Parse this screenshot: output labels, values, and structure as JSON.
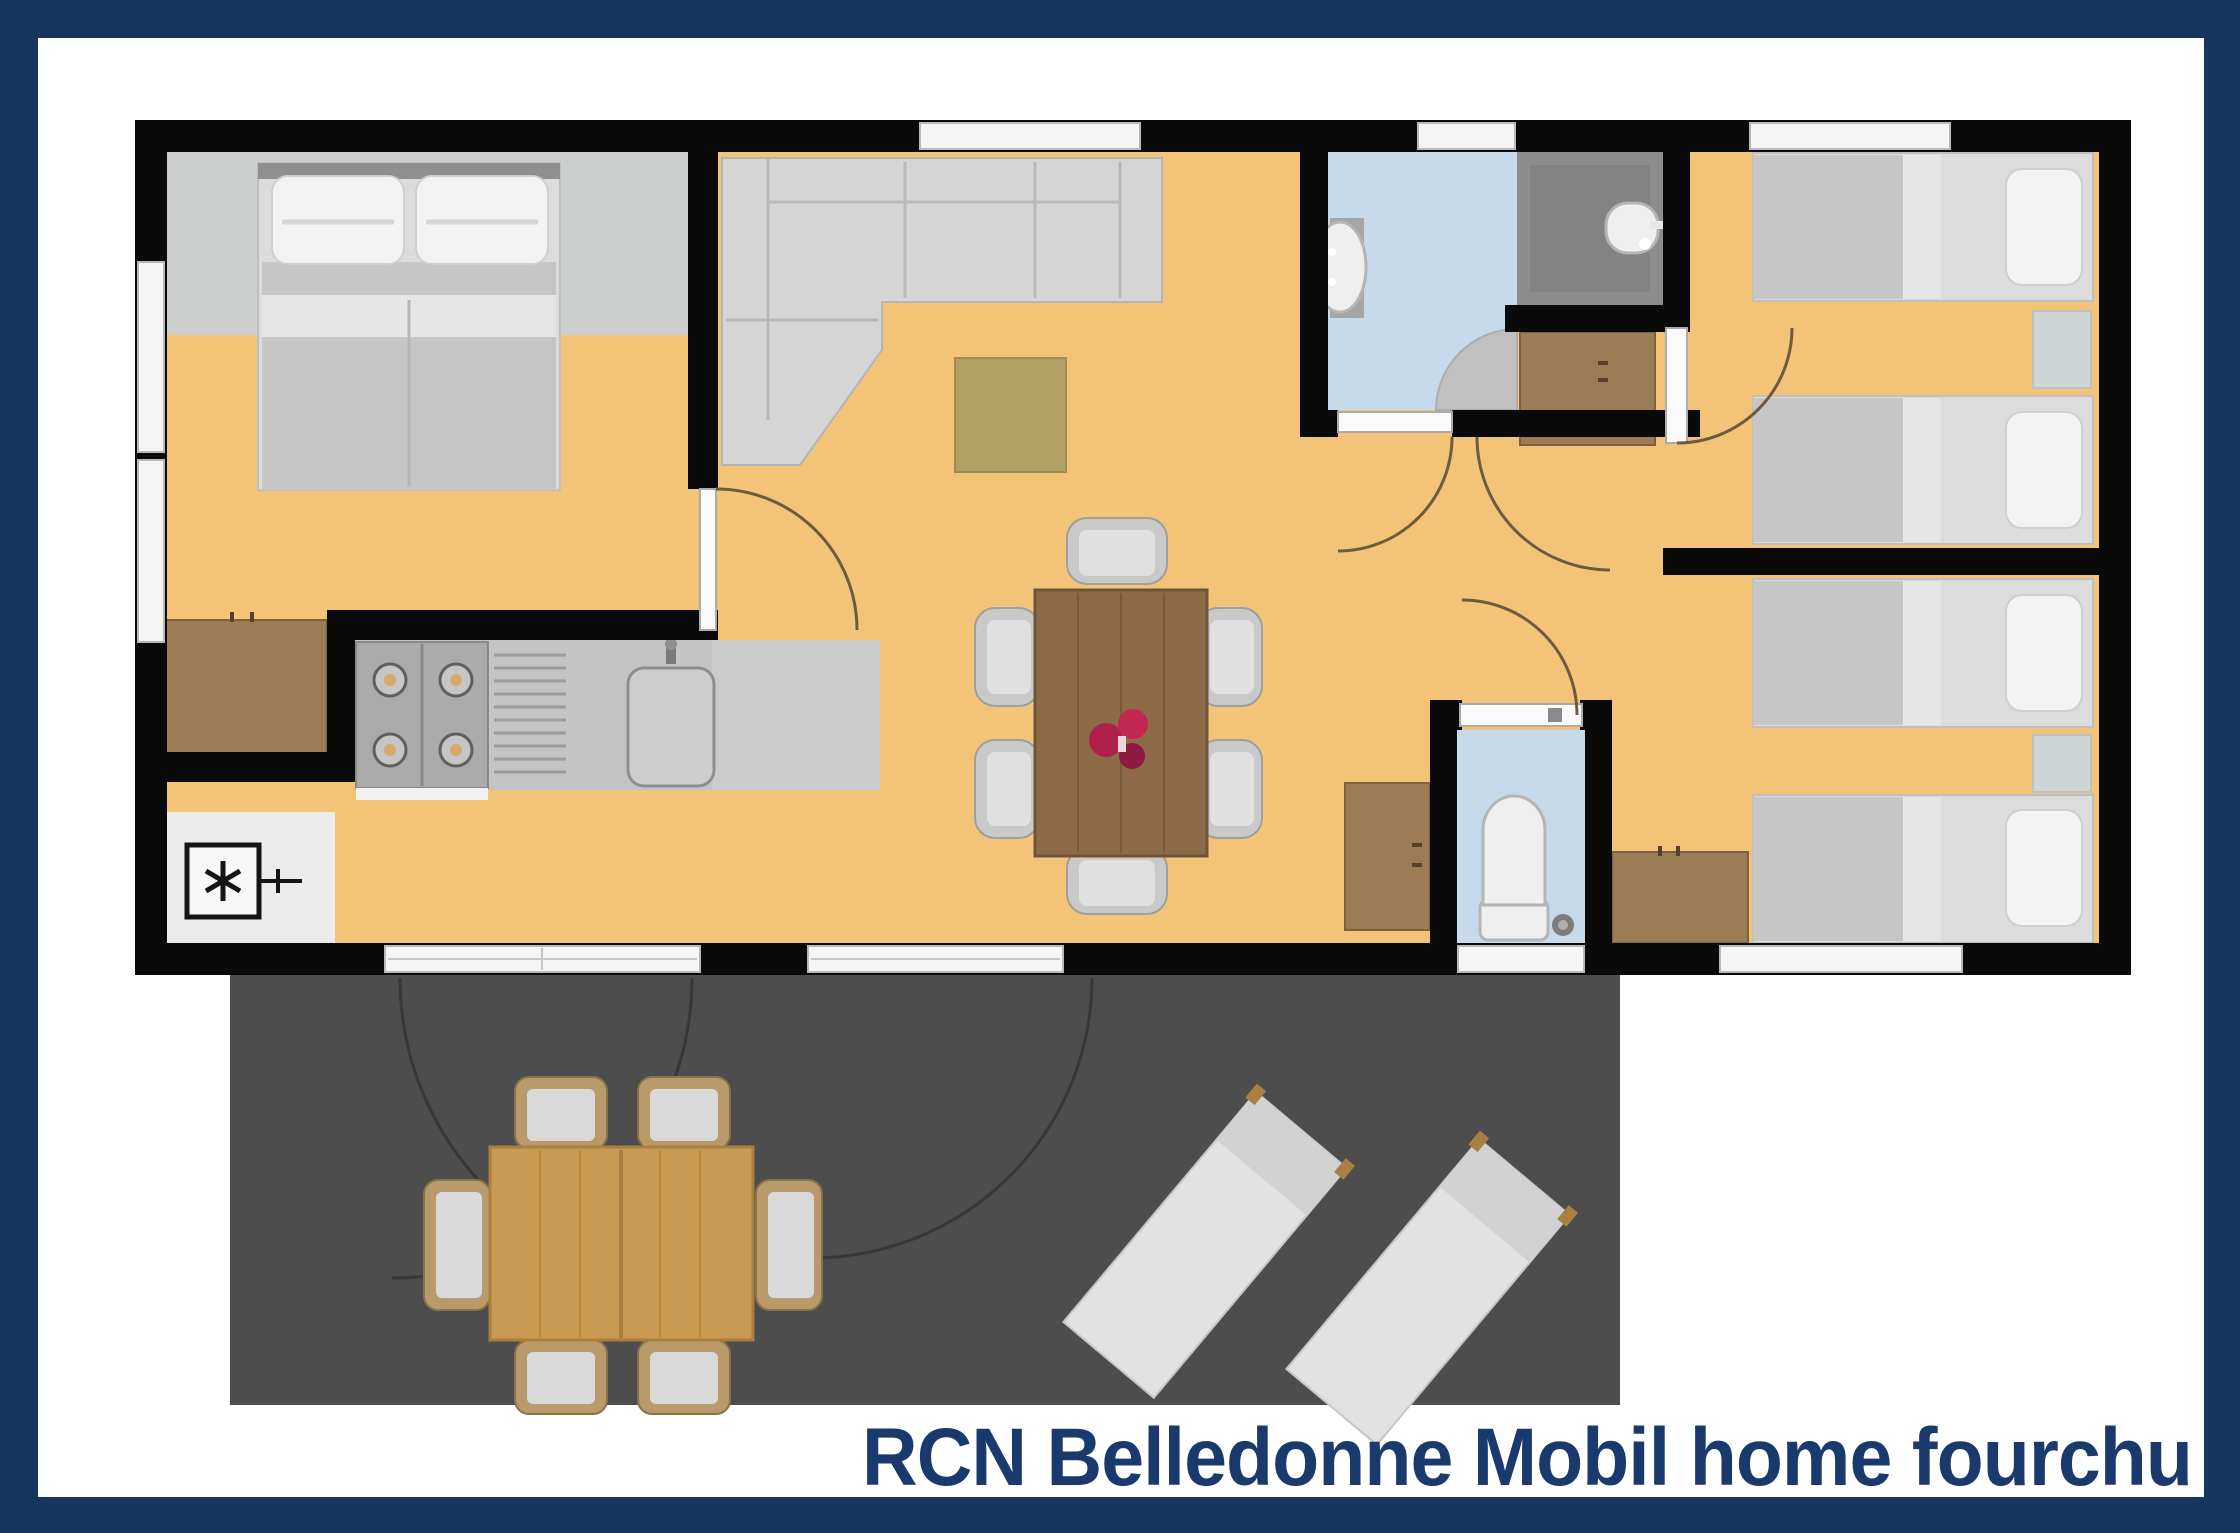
{
  "caption": {
    "text": "RCN Belledonne Mobil home fourchu"
  },
  "colors": {
    "border_navy": "#16365F",
    "caption_navy": "#1A3A6E",
    "wall_black": "#0A0A0A",
    "floor_orange": "#F3C477",
    "bathroom_blue": "#C6DAEC",
    "toilet_blue": "#C6DAEC",
    "shower_gray": "#8D8D8D",
    "bedroom_head_gray": "#CBCECD",
    "terrace_gray": "#4D4D4D",
    "wood_brown": "#9C7C55",
    "dining_table_wood": "#8D6B47",
    "outdoor_table_wood": "#C99B52",
    "rug_olive": "#B2A164",
    "flower_red": "#B0204C"
  },
  "plan": {
    "type": "floor-plan",
    "rooms": [
      {
        "name": "master-bedroom",
        "furniture": [
          "double-bed",
          "wardrobe"
        ]
      },
      {
        "name": "living-room",
        "furniture": [
          "corner-sofa",
          "rug",
          "dining-table",
          "six-chairs",
          "flower-centerpiece"
        ]
      },
      {
        "name": "kitchen",
        "furniture": [
          "fridge-freezer",
          "stove-4-burners",
          "drying-rack",
          "sink",
          "counter"
        ]
      },
      {
        "name": "bathroom",
        "furniture": [
          "washbasin",
          "corner-shower"
        ]
      },
      {
        "name": "shower-room",
        "furniture": [
          "wall-basin"
        ]
      },
      {
        "name": "toilet-room",
        "furniture": [
          "toilet"
        ]
      },
      {
        "name": "bedroom-right-top",
        "furniture": [
          "single-bed",
          "single-bed",
          "nightstand"
        ]
      },
      {
        "name": "bedroom-right-bottom",
        "furniture": [
          "single-bed",
          "single-bed",
          "nightstand",
          "wardrobe"
        ]
      },
      {
        "name": "terrace",
        "furniture": [
          "outdoor-table",
          "six-outdoor-chairs",
          "sun-lounger",
          "sun-lounger"
        ]
      }
    ],
    "icons": [
      "fridge-freezer-asterisk-icon",
      "door-swing-arc-icon",
      "window-icon",
      "sliding-door-icon"
    ]
  }
}
